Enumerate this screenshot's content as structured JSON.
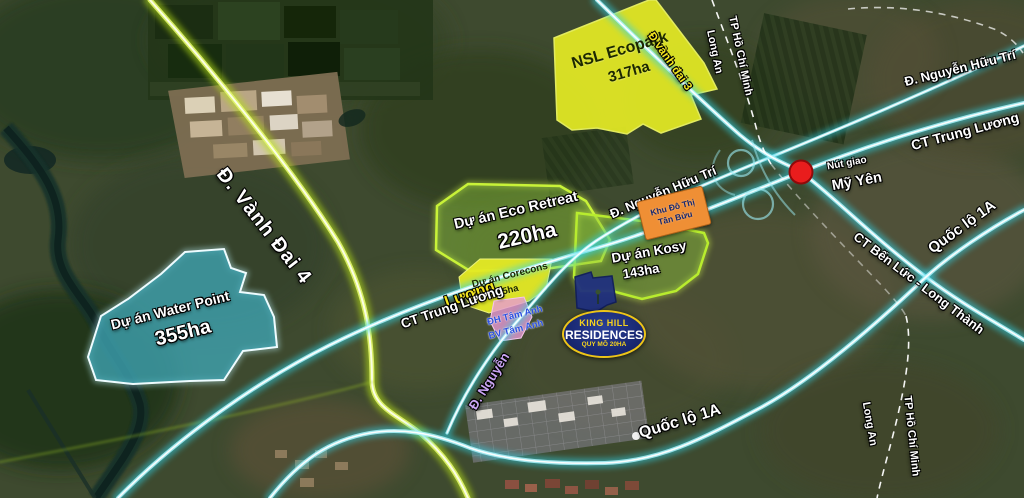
{
  "map": {
    "projects": {
      "nsl_ecopark": {
        "name": "NSL Ecopark",
        "area": "317ha"
      },
      "eco_retreat": {
        "name": "Dự án Eco Retreat",
        "area": "220ha"
      },
      "corecons": {
        "name": "Dự án Corecons",
        "area": "85ha"
      },
      "kosy": {
        "name": "Dự án Kosy",
        "area": "143ha"
      },
      "water_point": {
        "name": "Dự án Water Point",
        "area": "355ha"
      },
      "tan_buu": {
        "line1": "Khu Đô Thị",
        "line2": "Tân Bửu"
      },
      "tam_anh": {
        "line1": "ĐH Tâm Anh",
        "line2": "BV Tâm Anh"
      },
      "king_hill": {
        "brand_top": "KING HILL",
        "brand_main": "RESIDENCES",
        "scale": "QUY MÔ 20HA"
      }
    },
    "roads": {
      "vanh_dai_4": "Đ. Vành Đai 4",
      "vanh_dai_3": "Đ vành đai 3",
      "nguyen_huu_tri_mid": "Đ. Nguyễn Hữu Trí",
      "nguyen_huu_tri_ne": "Đ. Nguyễn Hữu Trí",
      "ct_trung_luong_ne": "CT Trung Lương",
      "ct_trung_luong_mid": "CT Trung Lương",
      "ct_trung_luong_mid_yellow": "Lương",
      "quoc_lo_1a_bottom": "Quốc lộ 1A",
      "quoc_lo_1a_right": "Quốc lộ 1A",
      "ct_ben_luc_long_thanh": "CT Bến Lức - Long Thành",
      "d_nguyen": "Đ. Nguyễn"
    },
    "junction": {
      "name_small": "Nút giao",
      "name_big": "Mỹ Yên"
    },
    "boundary": {
      "tphcm_top": "TP Hồ Chí Minh",
      "long_an_top": "Long An",
      "tphcm_bottom": "TP Hồ Chí Minh",
      "long_an_bottom": "Long An"
    },
    "colors": {
      "road_cyan": "#2ed4ea",
      "road_green": "#b8e312",
      "area_yellow": "#e4ea25",
      "area_green_border": "#c8f238",
      "water_teal": "#3fa3b0",
      "kinghill_navy": "#16246b",
      "tanbuu_orange": "#ef8f35",
      "junction_red": "#e91d1d"
    }
  }
}
